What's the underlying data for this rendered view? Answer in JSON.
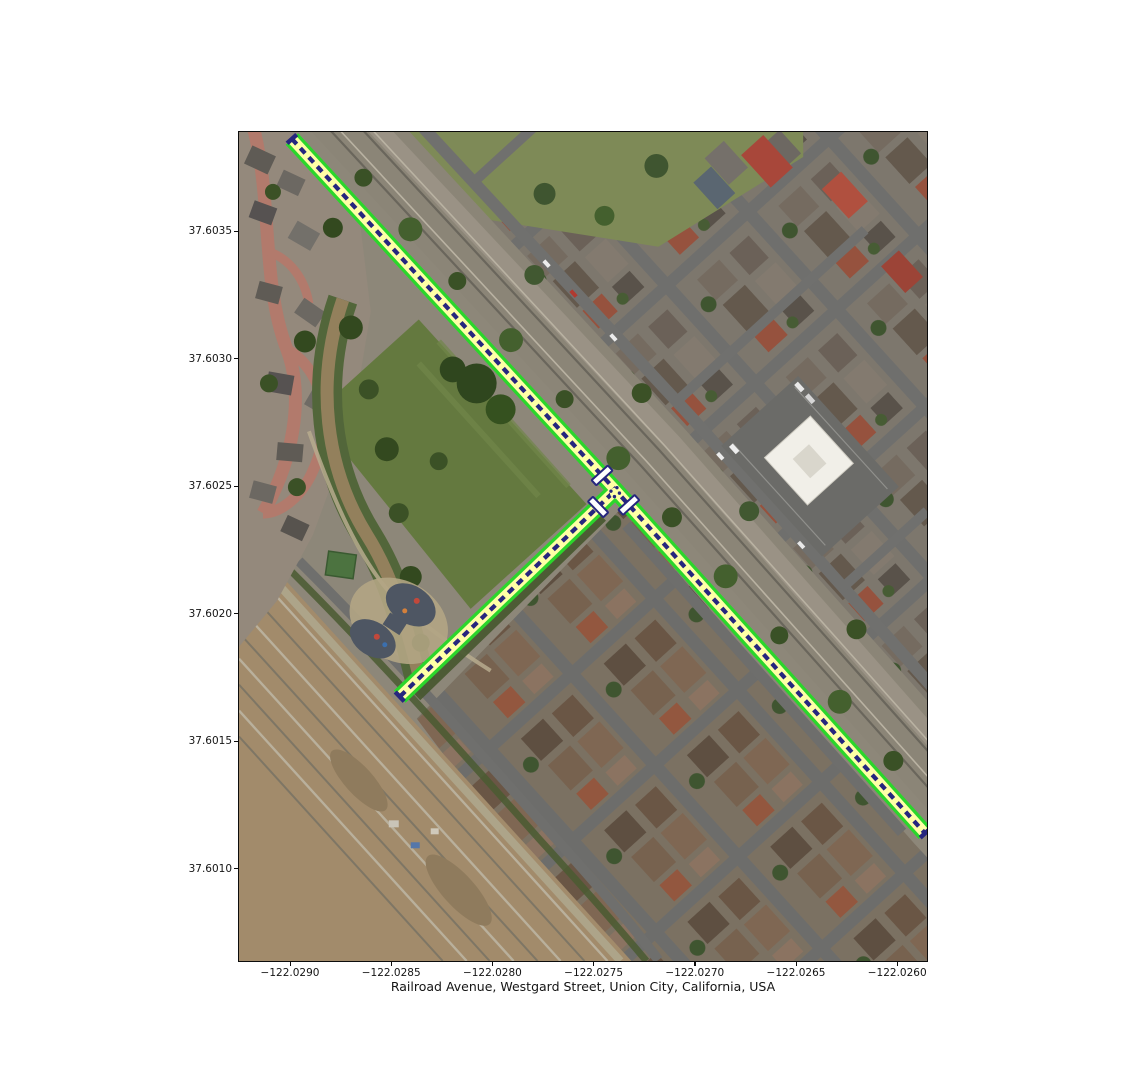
{
  "figure": {
    "xlabel": "Railroad Avenue, Westgard Street, Union City, California, USA",
    "x_axis": {
      "ticks": [
        "−122.0290",
        "−122.0285",
        "−122.0280",
        "−122.0275",
        "−122.0270",
        "−122.0265",
        "−122.0260"
      ]
    },
    "y_axis": {
      "ticks": [
        "37.6035",
        "37.6030",
        "37.6025",
        "37.6020",
        "37.6015",
        "37.6010"
      ]
    }
  },
  "map": {
    "basemap": "aerial-imagery",
    "place": "Union City, California, USA",
    "extent": {
      "lon_min": -122.02925,
      "lon_max": -122.02585,
      "lat_min": 37.60063,
      "lat_max": 37.60389
    },
    "routes": [
      {
        "name": "Railroad Avenue",
        "from": {
          "lon": -122.02897,
          "lat": 37.60385
        },
        "via": {
          "lon": -122.02738,
          "lat": 37.60249
        },
        "to": {
          "lon": -122.02586,
          "lat": 37.60113
        }
      },
      {
        "name": "Westgard Street",
        "from": {
          "lon": -122.02738,
          "lat": 37.60249
        },
        "to": {
          "lon": -122.02845,
          "lat": 37.60167
        }
      }
    ],
    "route_style": {
      "outline_color": "#2bd62b",
      "fill_color": "#ffffa6",
      "centerline_color": "#26267e",
      "node_marker_fill": "#ffffff",
      "node_marker_border": "#26267e"
    }
  }
}
